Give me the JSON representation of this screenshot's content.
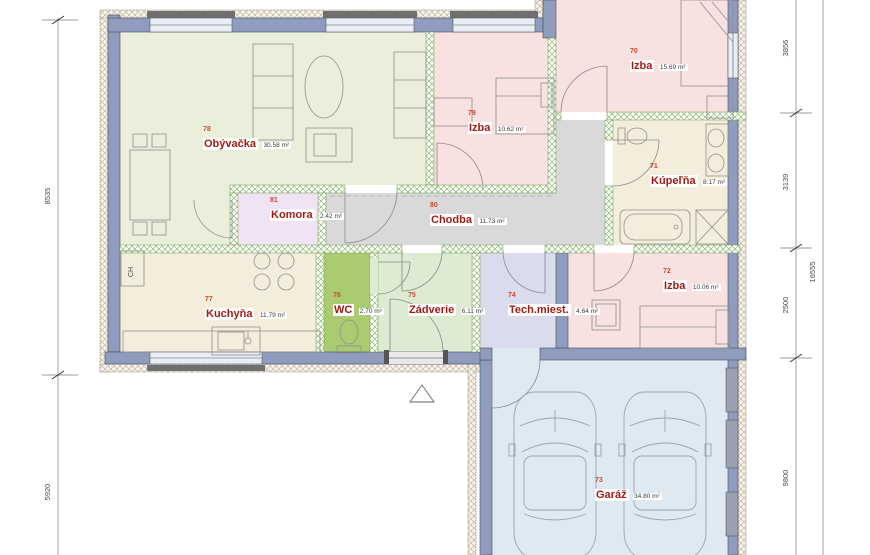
{
  "plan": {
    "rooms": [
      {
        "id": "obyvacka",
        "number": "78",
        "name": "Obývačka",
        "area": "30.58 m²",
        "color": "#e9efda"
      },
      {
        "id": "izba-79",
        "number": "79",
        "name": "Izba",
        "area": "10.62 m²",
        "color": "#f8e1e1"
      },
      {
        "id": "izba-70",
        "number": "70",
        "name": "Izba",
        "area": "15.69 m²",
        "color": "#f8e1e1"
      },
      {
        "id": "kupelna",
        "number": "71",
        "name": "Kúpeľňa",
        "area": "8.17 m²",
        "color": "#f4eddb"
      },
      {
        "id": "komora",
        "number": "81",
        "name": "Komora",
        "area": "2.42 m²",
        "color": "#f0e3f3"
      },
      {
        "id": "chodba",
        "number": "80",
        "name": "Chodba",
        "area": "11.73 m²",
        "color": "#d9d9d9"
      },
      {
        "id": "kuchyna",
        "number": "77",
        "name": "Kuchyňa",
        "area": "11.79 m²",
        "color": "#f4eddb"
      },
      {
        "id": "wc",
        "number": "76",
        "name": "WC",
        "area": "2.70 m²",
        "color": "#aacb70"
      },
      {
        "id": "zadverie",
        "number": "75",
        "name": "Zádverie",
        "area": "6.11 m²",
        "color": "#dcebd1"
      },
      {
        "id": "tech-miest",
        "number": "74",
        "name": "Tech.miest.",
        "area": "4.64 m²",
        "color": "#dbdbee"
      },
      {
        "id": "izba-72",
        "number": "72",
        "name": "Izba",
        "area": "10.06 m²",
        "color": "#f8e1e1"
      },
      {
        "id": "garaz",
        "number": "73",
        "name": "Garáž",
        "area": "34.80 m²",
        "color": "#dfe9f1"
      }
    ],
    "dimensions": {
      "left": [
        "8535",
        "5920"
      ],
      "right": [
        "3856",
        "3139",
        "2500",
        "9800"
      ],
      "right_total": "16555"
    },
    "labels": {
      "fridge": "CH"
    },
    "colors": {
      "wall": "#8f9cbd",
      "room_number": "#cf4a30",
      "room_name": "#9e1b15",
      "dimension_text": "#4a4a4a"
    }
  }
}
